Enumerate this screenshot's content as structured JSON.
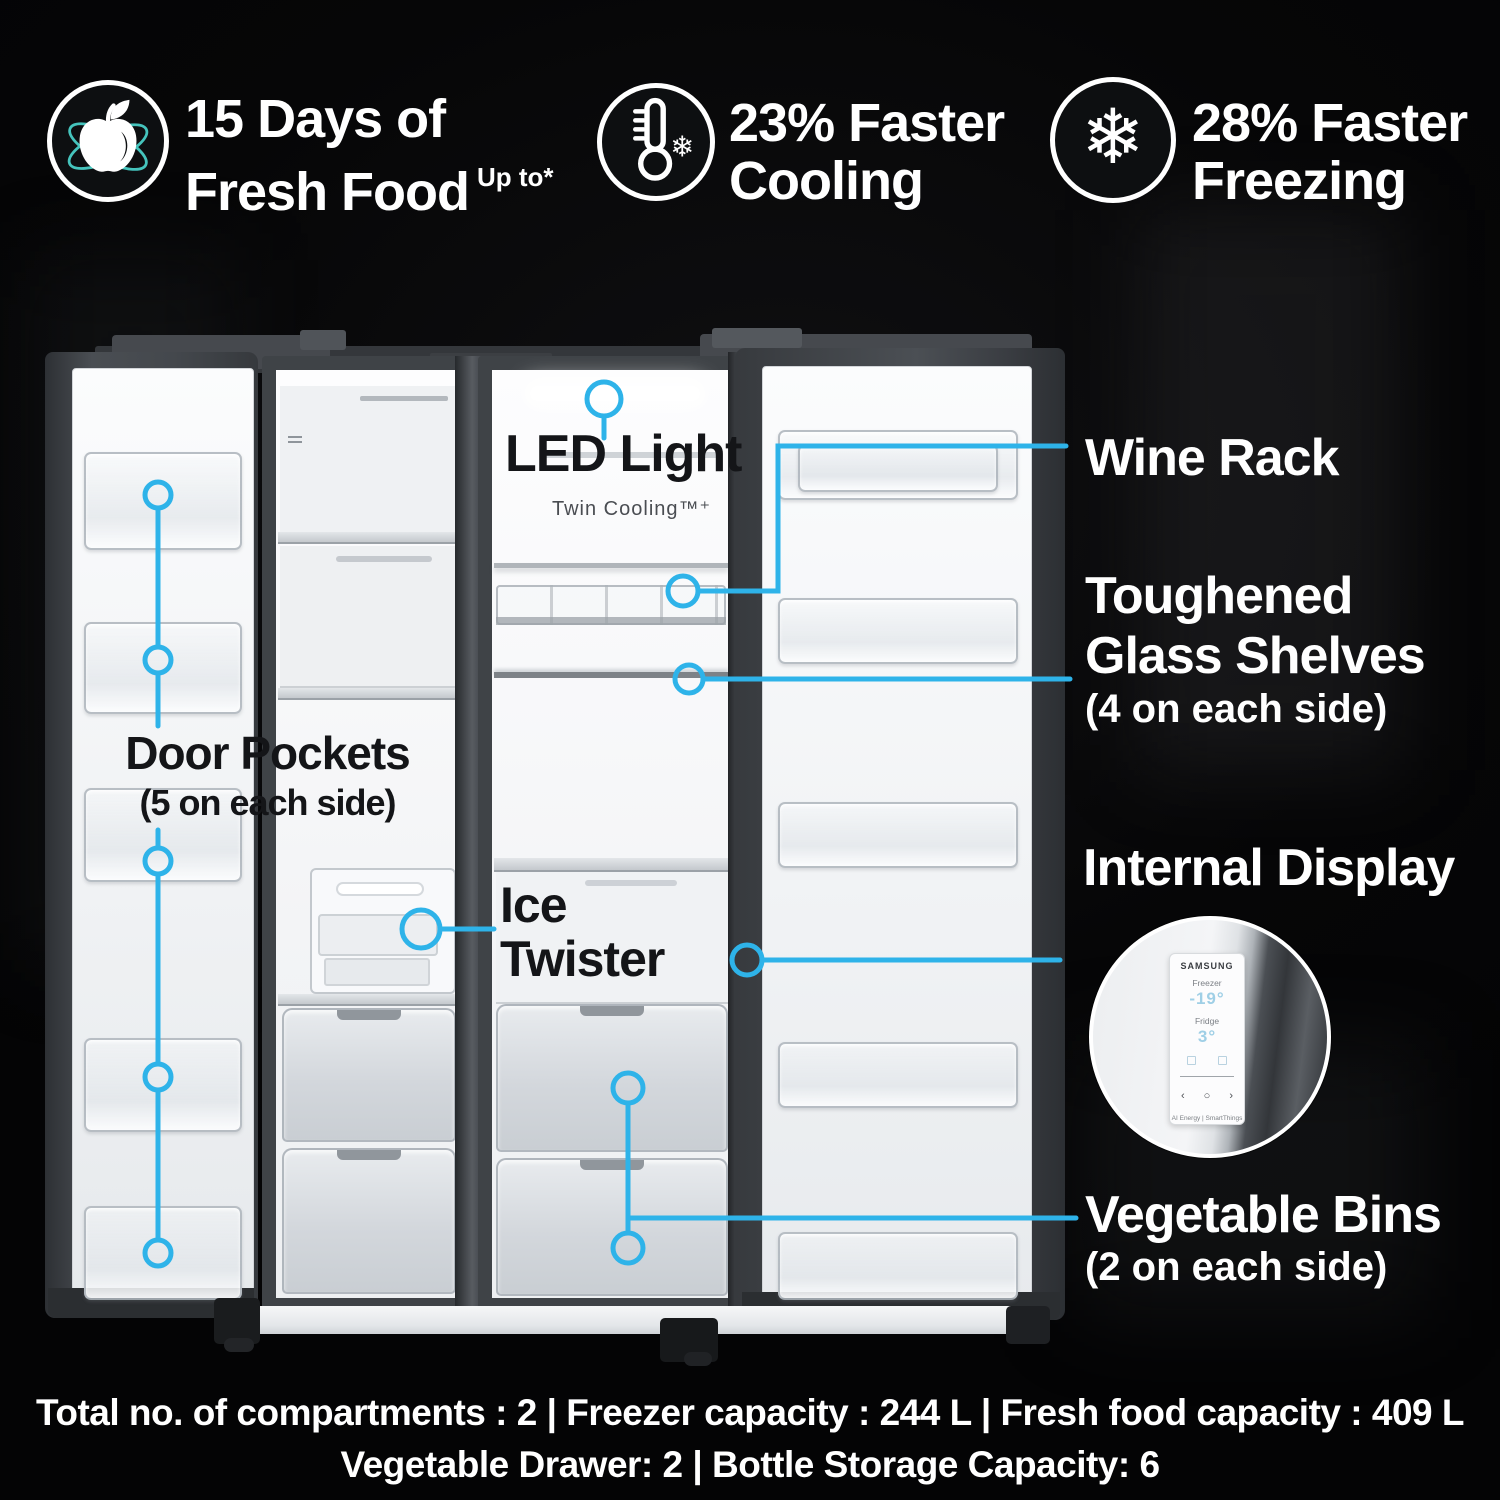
{
  "colors": {
    "accent_blue": "#2EB3E9",
    "orbit_teal": "#45C4BD",
    "background": "#050505"
  },
  "icons": {
    "snowflake_glyph": "❄"
  },
  "badges": [
    {
      "icon": "apple-orbit-icon",
      "line1": "15 Days of",
      "line2": "Fresh Food",
      "sup": "Up to*"
    },
    {
      "icon": "thermometer-snowflake-icon",
      "line1": "23% Faster",
      "line2": "Cooling"
    },
    {
      "icon": "snowflake-icon",
      "line1": "28% Faster",
      "line2": "Freezing"
    }
  ],
  "fridge_labels": {
    "led_light": "LED Light",
    "twin_cooling": "Twin Cooling™⁺",
    "door_pockets": "Door Pockets",
    "door_pockets_note": "(5 on each side)",
    "ice_line1": "Ice",
    "ice_line2": "Twister"
  },
  "right_labels": {
    "wine_rack": "Wine Rack",
    "glass_shelves_line1": "Toughened",
    "glass_shelves_line2": "Glass Shelves",
    "glass_shelves_note": "(4 on each side)",
    "internal_display": "Internal Display",
    "vegetable_bins": "Vegetable Bins",
    "vegetable_bins_note": "(2 on each side)"
  },
  "display_panel": {
    "brand": "SAMSUNG",
    "freezer_label": "Freezer",
    "freezer_temp": "-19°",
    "fridge_label": "Fridge",
    "fridge_temp": "3°",
    "controls": "‹ ○ ›",
    "footer": "AI Energy | SmartThings"
  },
  "specs": {
    "line1": "Total no. of compartments : 2 | Freezer capacity : 244 L | Fresh food capacity : 409 L",
    "line2": "Vegetable Drawer: 2 | Bottle Storage Capacity: 6"
  }
}
